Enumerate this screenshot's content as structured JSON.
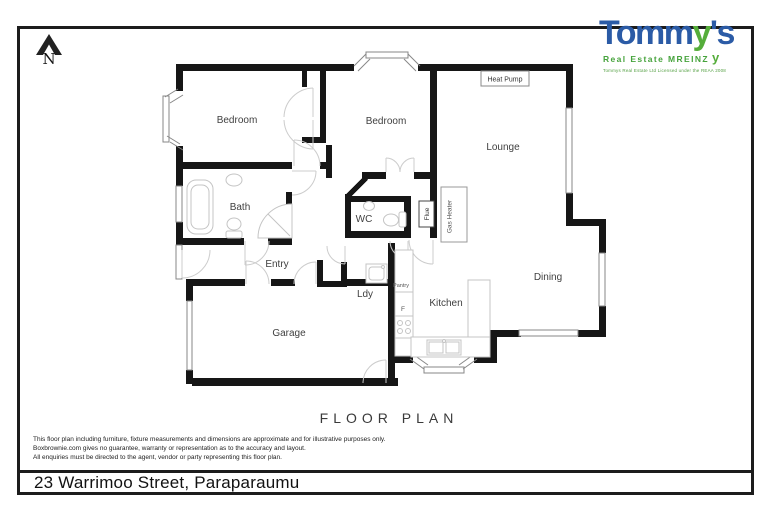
{
  "logo": {
    "brand_t": "Tomm",
    "brand_y": "y",
    "brand_s": "'s",
    "tagline": "Real Estate MREINZ",
    "glyph": "y",
    "license": "Tommys Real Estate Ltd Licensed under the REAA 2008"
  },
  "compass": {
    "label": "N"
  },
  "floor_plan": {
    "title": "FLOOR PLAN",
    "labels": {
      "bedroom1": "Bedroom",
      "bedroom2": "Bedroom",
      "lounge": "Lounge",
      "bath": "Bath",
      "wc": "WC",
      "entry": "Entry",
      "dining": "Dining",
      "laundry": "Ldy",
      "kitchen": "Kitchen",
      "garage": "Garage",
      "pantry": "Pantry",
      "fridge": "F"
    },
    "equipment": {
      "heat_pump": "Heat Pump",
      "gas_heater": "Gas Heater",
      "flue": "Flue"
    }
  },
  "disclaimer": {
    "line1": "This floor plan including furniture, fixture measurements and dimensions are approximate and for illustrative purposes only.",
    "line2": "Boxbrownie.com gives no guarantee, warranty or representation as to the accuracy and layout.",
    "line3": "All enquiries must be directed to the agent, vendor or party representing this floor plan."
  },
  "address": {
    "text": "23 Warrimoo Street, Paraparaumu"
  },
  "colors": {
    "wall": "#161616",
    "brand_blue": "#2b5ba6",
    "brand_green": "#55ad3a",
    "window_stroke": "#878787",
    "door_stroke": "#cccccc",
    "fixture_stroke": "#c4c4c4"
  }
}
